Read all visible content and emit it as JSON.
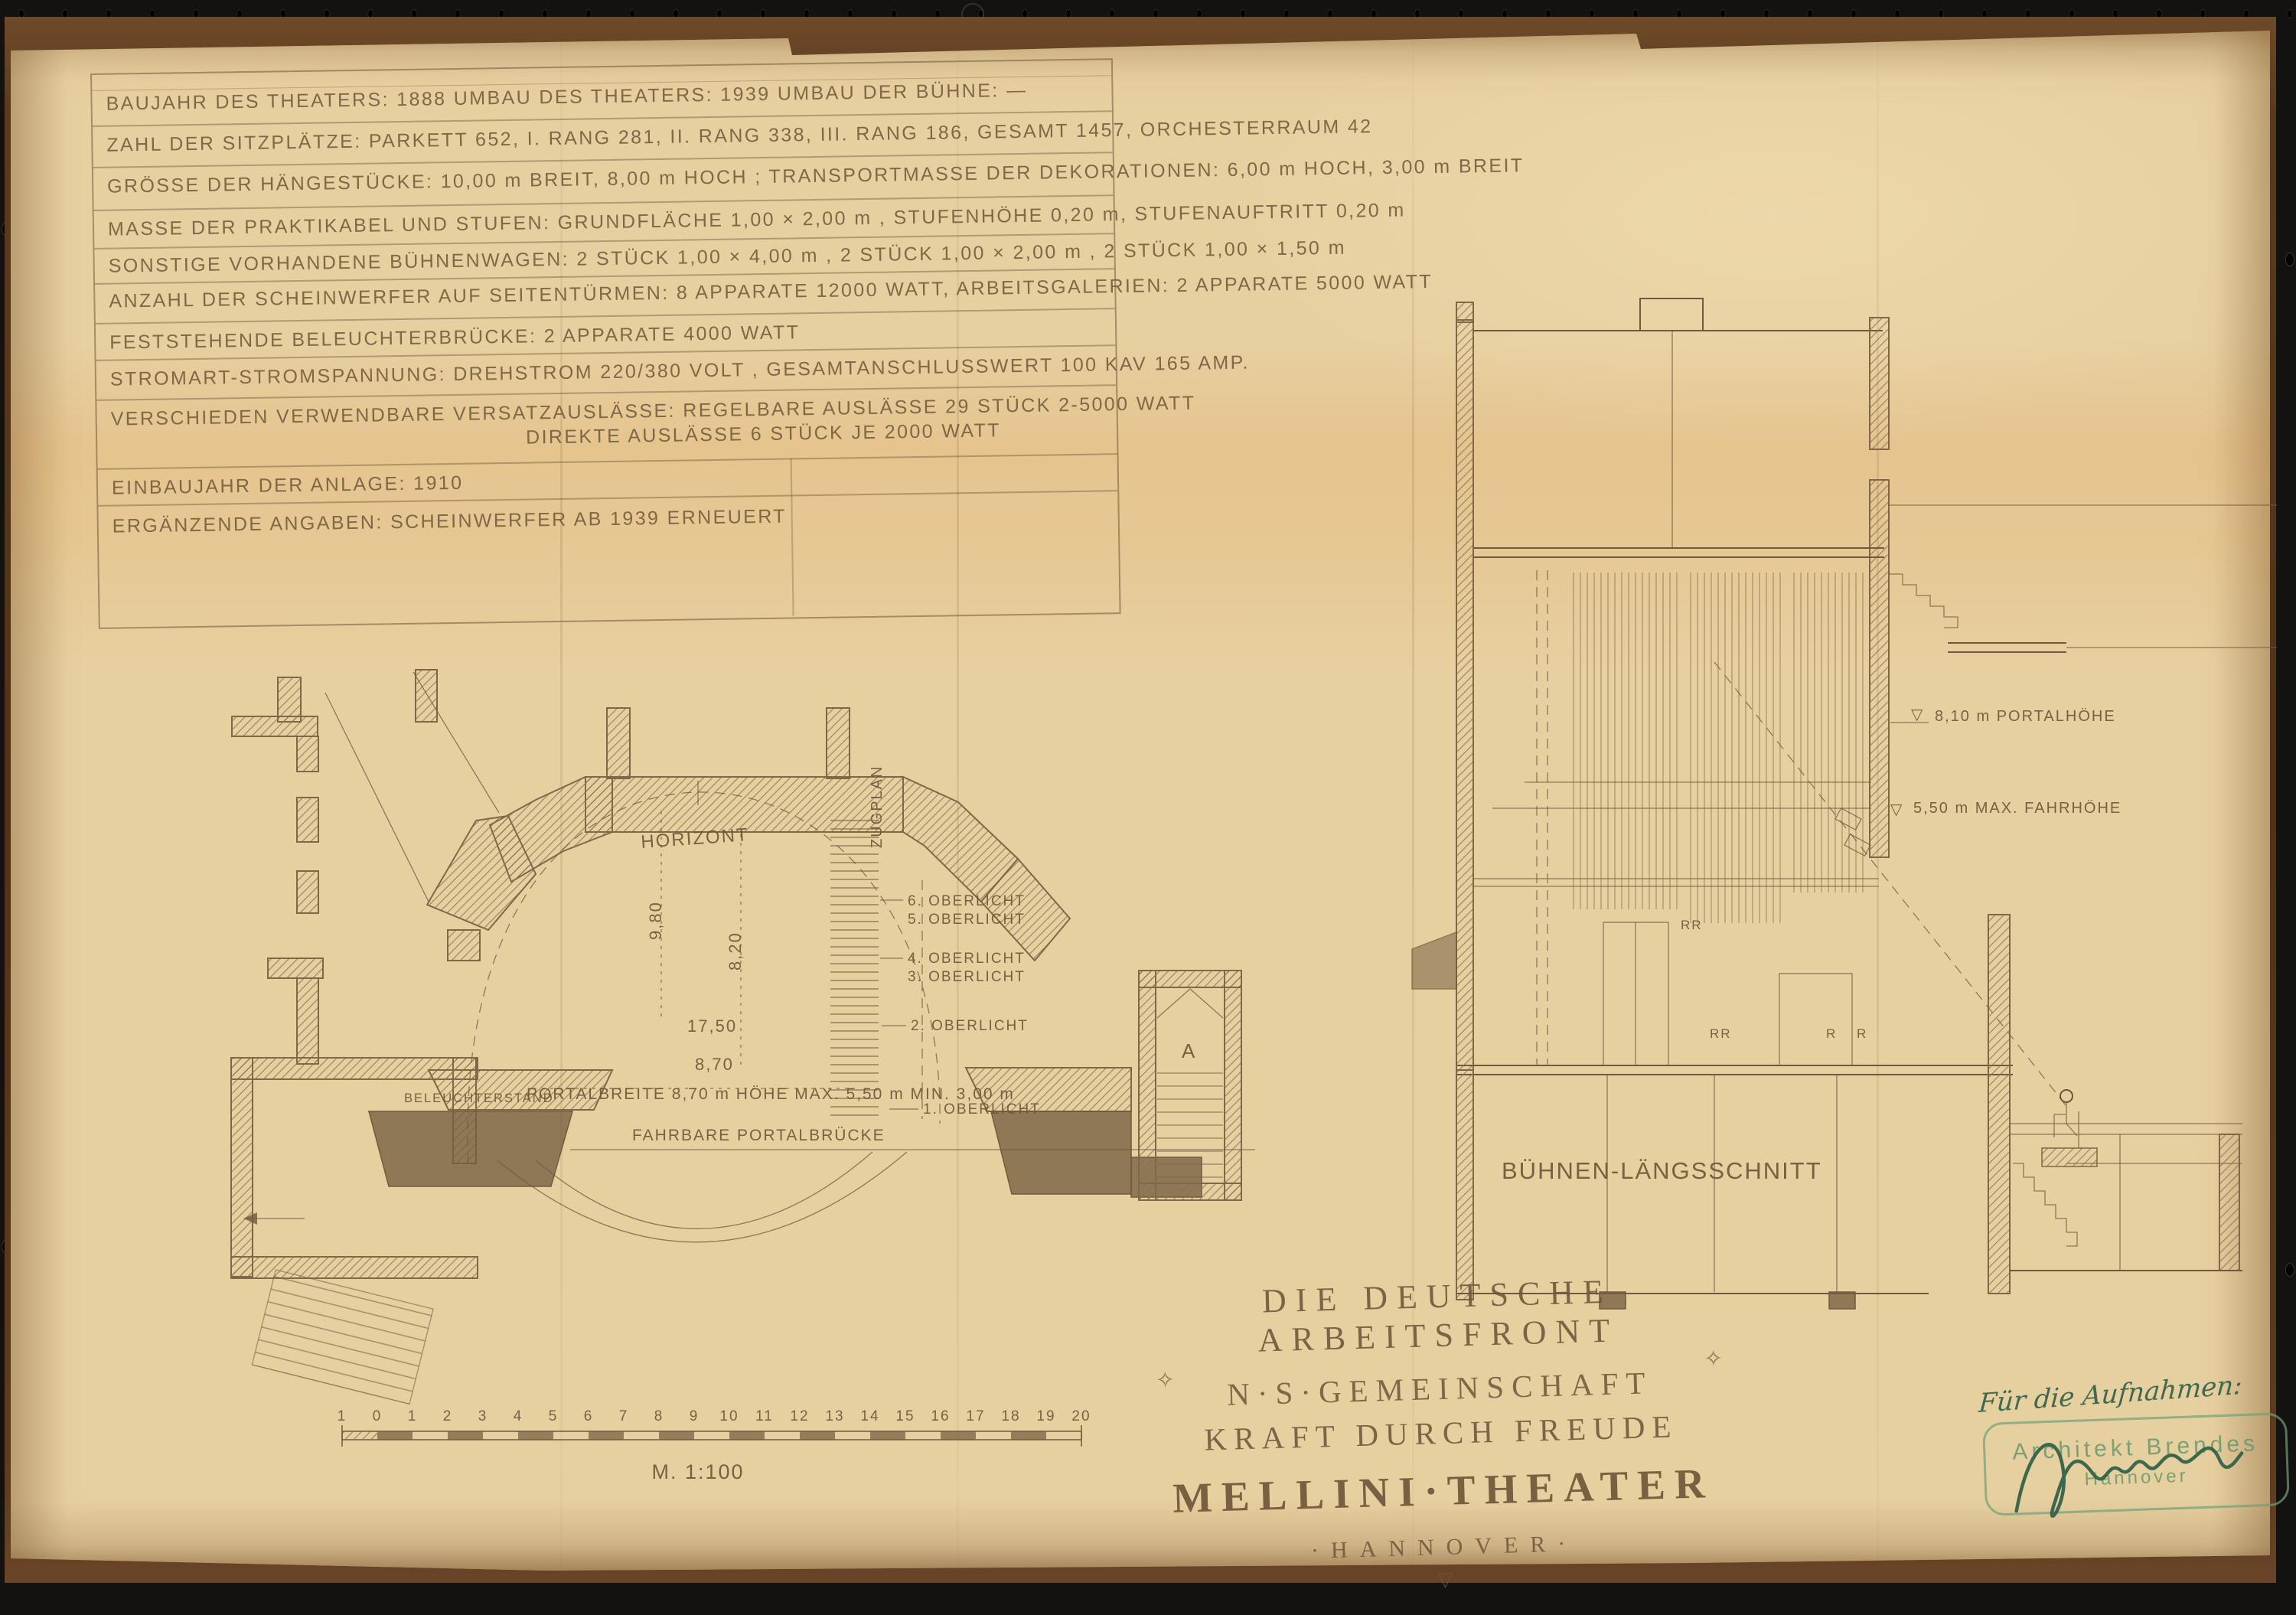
{
  "colors": {
    "paper": "#e7d0a0",
    "ink": "#6d5639",
    "mount_brown": "#5a3a1f",
    "background_black": "#141210",
    "stamp_green": "#5f9468",
    "signature_green": "#2e5f47"
  },
  "info_box": {
    "rows": [
      "BAUJAHR DES THEATERS: 1888   UMBAU DES THEATERS: 1939   UMBAU DER BÜHNE: —",
      "ZAHL DER SITZPLÄTZE: PARKETT 652, I. RANG 281, II. RANG 338, III. RANG 186, GESAMT 1457, ORCHESTERRAUM 42",
      "GRÖSSE DER HÄNGESTÜCKE: 10,00 m BREIT, 8,00 m HOCH ; TRANSPORTMASSE DER DEKORATIONEN: 6,00 m HOCH, 3,00 m BREIT",
      "MASSE DER PRAKTIKABEL UND STUFEN: GRUNDFLÄCHE 1,00 × 2,00 m , STUFENHÖHE 0,20 m, STUFENAUFTRITT 0,20 m",
      "SONSTIGE VORHANDENE BÜHNENWAGEN: 2 STÜCK 1,00 × 4,00 m , 2 STÜCK 1,00 × 2,00 m , 2 STÜCK 1,00 × 1,50 m",
      "ANZAHL DER SCHEINWERFER AUF SEITENTÜRMEN: 8 APPARATE 12000 WATT, ARBEITSGALERIEN: 2 APPARATE 5000 WATT",
      "FESTSTEHENDE BELEUCHTERBRÜCKE: 2 APPARATE 4000 WATT",
      "STROMART-STROMSPANNUNG: DREHSTROM 220/380 VOLT , GESAMTANSCHLUSSWERT 100 KAV 165 AMP.",
      "VERSCHIEDEN VERWENDBARE VERSATZAUSLÄSSE: REGELBARE AUSLÄSSE 29 STÜCK 2-5000 WATT",
      "DIREKTE AUSLÄSSE 6 STÜCK JE 2000 WATT",
      "EINBAUJAHR DER ANLAGE: 1910",
      "ERGÄNZENDE ANGABEN: SCHEINWERFER AB 1939 ERNEUERT"
    ]
  },
  "plan": {
    "labels": {
      "horizont": "HORIZONT",
      "zugplan": "ZUGPLAN",
      "dim_9_80": "9,80",
      "dim_8_20": "8,20",
      "dim_17_50": "17,50",
      "dim_8_70": "8,70",
      "portal_dims": "PORTALBREITE 8,70 m  HÖHE MAX. 5,50 m  MIN. 3,00 m",
      "portal_bridge": "FAHRBARE PORTALBRÜCKE",
      "lighting_stand": "BELEUCHTERSTAND",
      "oberlicht": [
        "6. OBERLICHT",
        "5. OBERLICHT",
        "4. OBERLICHT",
        "3. OBERLICHT",
        "2. OBERLICHT",
        "1. OBERLICHT"
      ],
      "stair_letter": "A"
    }
  },
  "scalebar": {
    "numbers": [
      "1",
      "0",
      "1",
      "2",
      "3",
      "4",
      "5",
      "6",
      "7",
      "8",
      "9",
      "10",
      "11",
      "12",
      "13",
      "14",
      "15",
      "16",
      "17",
      "18",
      "19",
      "20"
    ],
    "caption": "M. 1:100"
  },
  "section": {
    "labels": {
      "marker": "▽",
      "portal_height": "8,10 m PORTALHÖHE",
      "max_travel": "5,50 m MAX. FAHRHÖHE",
      "caption": "BÜHNEN-LÄNGSSCHNITT",
      "rr": "RR",
      "r": "R"
    }
  },
  "title_block": {
    "line1": "DIE DEUTSCHE ARBEITSFRONT",
    "line2": "N·S·GEMEINSCHAFT",
    "line3": "KRAFT DURCH FREUDE",
    "line4": "MELLINI·THEATER",
    "line5": "·HANNOVER·",
    "diamond": "✧",
    "triangle": "▽"
  },
  "annotation": {
    "handwritten": "Für die Aufnahmen:",
    "stamp_line1": "Architekt Brendes",
    "stamp_line2": "Hannover"
  }
}
